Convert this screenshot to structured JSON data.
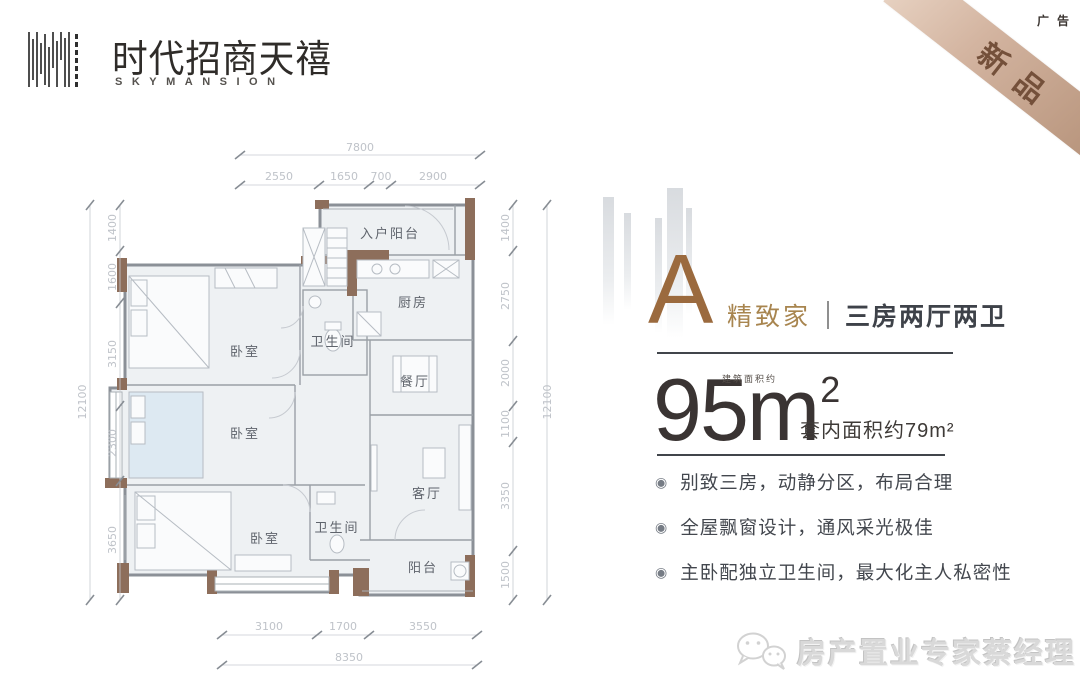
{
  "brand": {
    "name_cn": "时代招商天禧",
    "name_en": "SKYMANSION"
  },
  "corner": {
    "ad_tag": "广告",
    "ribbon_label": "新品"
  },
  "unit": {
    "type_letter": "A",
    "tagline": "精致家",
    "layout_desc": "三房两厅两卫",
    "area": {
      "builtup_prefix": "建筑面积约",
      "value": "95",
      "unit_letter": "m",
      "unit_exponent": "2",
      "inner_area": "套内面积约79m²"
    },
    "bullet_icon": "◉",
    "features": [
      "别致三房，动静分区，布局合理",
      "全屋飘窗设计，通风采光极佳",
      "主卧配独立卫生间，最大化主人私密性"
    ]
  },
  "floorplan": {
    "rooms": {
      "entry_balcony": "入户阳台",
      "kitchen": "厨房",
      "dining": "餐厅",
      "bath_upper": "卫生间",
      "bedroom_upper": "卧室",
      "bedroom_middle": "卧室",
      "bedroom_master": "卧室",
      "bath_lower": "卫生间",
      "living": "客厅",
      "balcony": "阳台"
    },
    "dims": {
      "top_total": "7800",
      "top_segments": [
        "2550",
        "1650",
        "700",
        "2900"
      ],
      "bottom_segments": [
        "3100",
        "1700",
        "3550"
      ],
      "bottom_total": "8350",
      "left_total": "12100",
      "left_segments": [
        "1400",
        "1600",
        "3150",
        "2300",
        "3650"
      ],
      "right_segments": [
        "1400",
        "2750",
        "2000",
        "1100",
        "3350",
        "1500"
      ],
      "right_total": "12100"
    }
  },
  "watermark": {
    "icon": "wechat-icon",
    "text": "房产置业专家蔡经理"
  }
}
